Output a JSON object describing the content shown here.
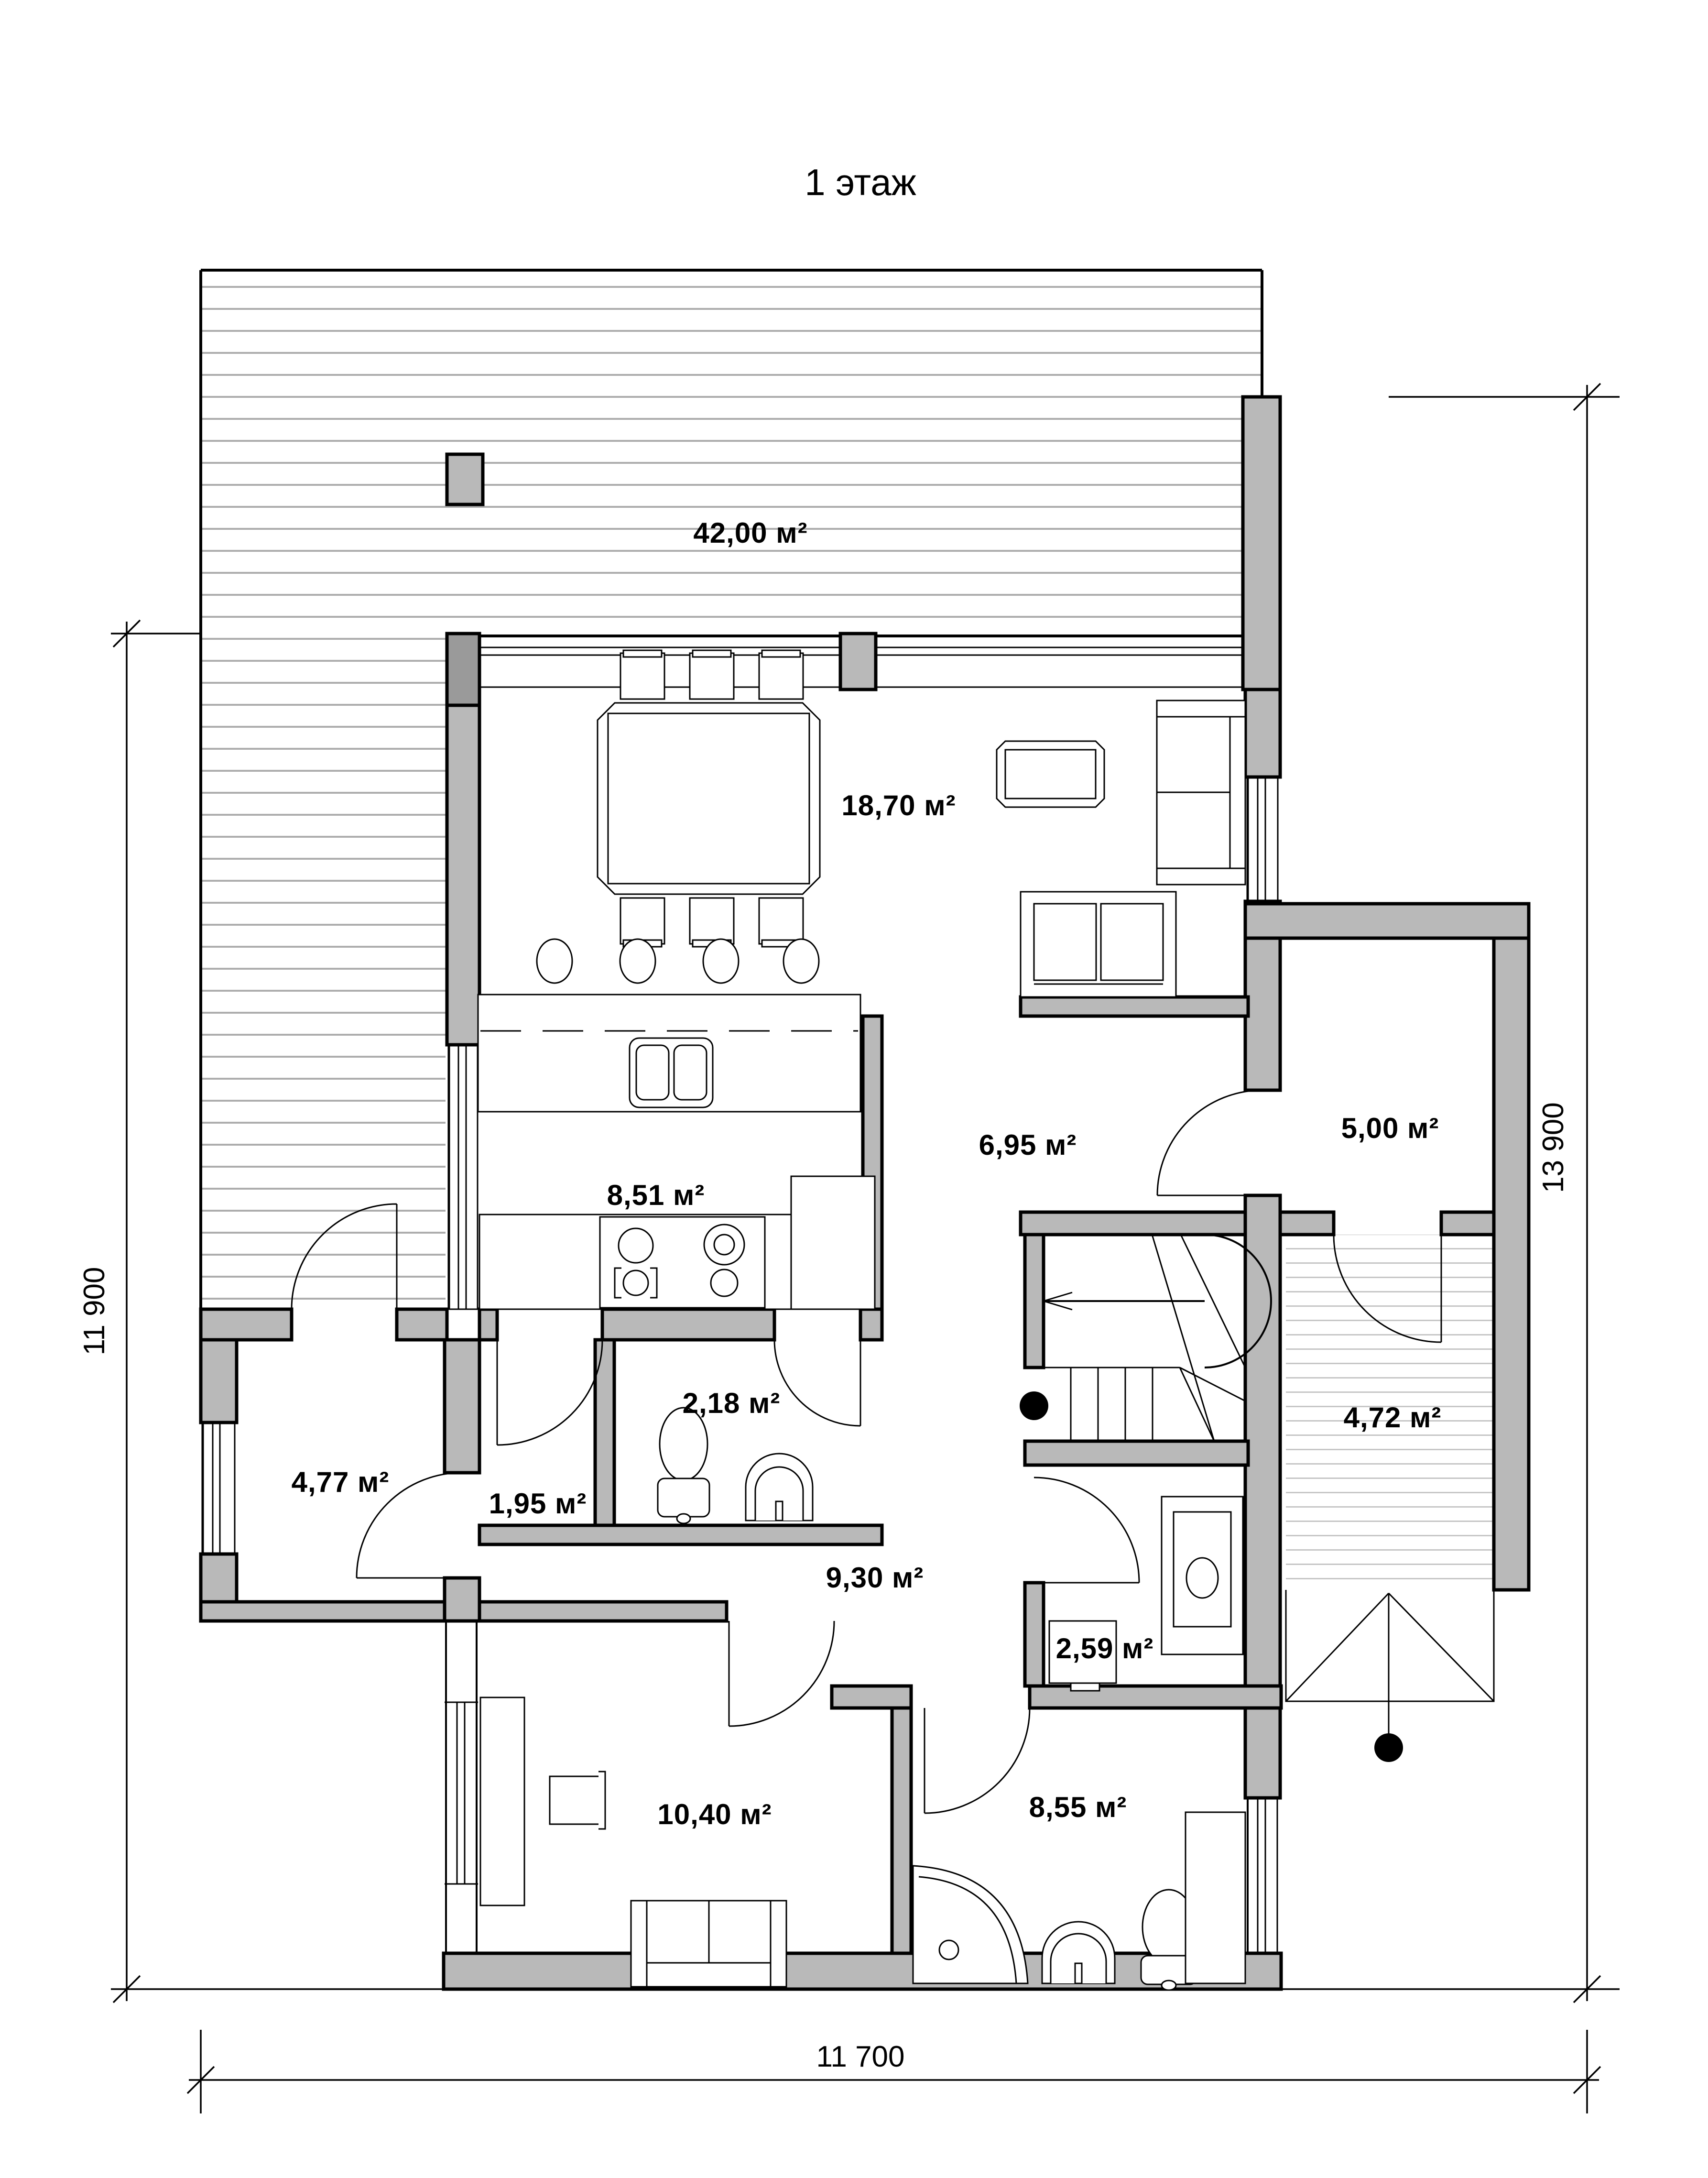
{
  "title": "1 этаж",
  "rooms": [
    {
      "name": "terrace",
      "area_label": "42,00 м²"
    },
    {
      "name": "living",
      "area_label": "18,70 м²"
    },
    {
      "name": "kitchen",
      "area_label": "8,51 м²"
    },
    {
      "name": "hallway",
      "area_label": "6,95 м²"
    },
    {
      "name": "storage",
      "area_label": "5,00 м²"
    },
    {
      "name": "wc",
      "area_label": "2,18 м²"
    },
    {
      "name": "lobby",
      "area_label": "1,95 м²"
    },
    {
      "name": "mudroom",
      "area_label": "4,77 м²"
    },
    {
      "name": "entry",
      "area_label": "4,72 м²"
    },
    {
      "name": "hall",
      "area_label": "9,30 м²"
    },
    {
      "name": "boiler",
      "area_label": "2,59 м²"
    },
    {
      "name": "office",
      "area_label": "10,40 м²"
    },
    {
      "name": "bathroom",
      "area_label": "8,55 м²"
    }
  ],
  "dimensions": {
    "left": "11 900",
    "right": "13 900",
    "bottom": "11 700"
  },
  "colors": {
    "wall_fill": "#b9b9b9",
    "hatch_terrace": "#adadad",
    "hatch_entry": "#c6c6c6"
  }
}
